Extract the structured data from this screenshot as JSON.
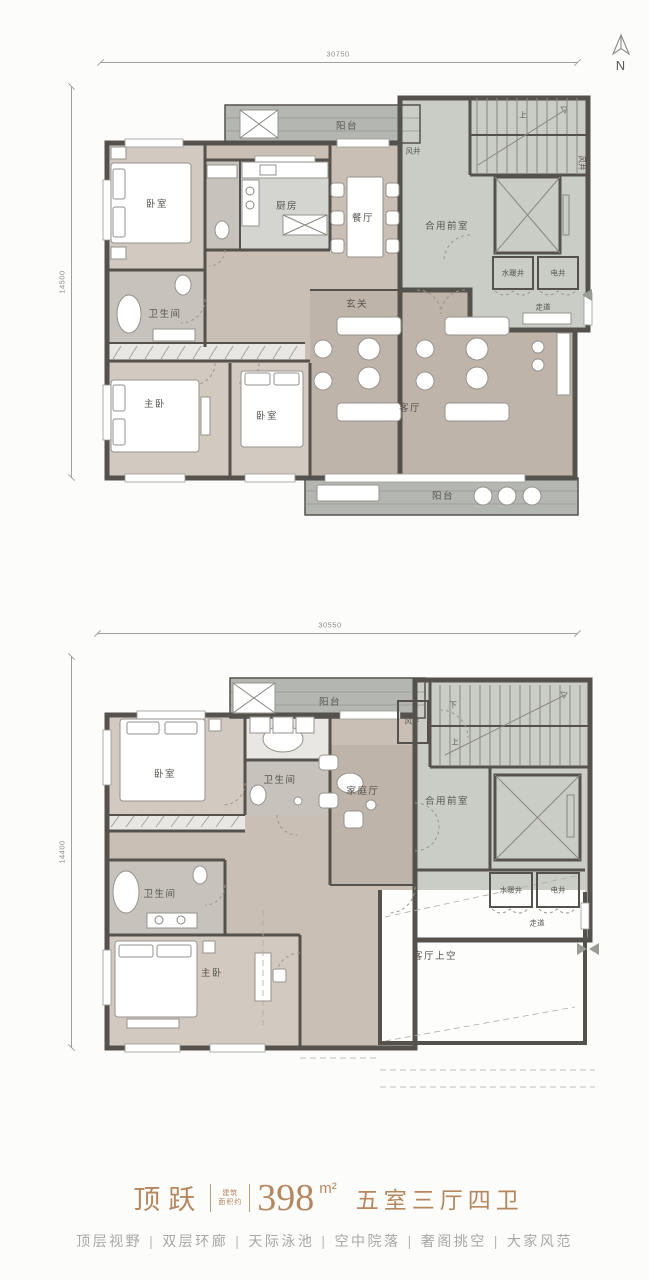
{
  "north": {
    "letter": "N"
  },
  "dimensions": {
    "upper_top": "30750",
    "upper_left": "14500",
    "lower_top": "30550",
    "lower_left": "14400"
  },
  "plans": {
    "upper": {
      "labels": {
        "balcony_top": "阳台",
        "air_shaft": "风井",
        "air_shaft2": "风井",
        "stair_up": "上",
        "kitchen": "厨房",
        "dining": "餐厅",
        "vestibule": "合用前室",
        "bedroom1": "卧室",
        "bath1": "卫生间",
        "foyer": "玄关",
        "plumbing_shaft": "水暖井",
        "electric_shaft": "电井",
        "corridor": "走道",
        "master_bedroom": "主卧",
        "bedroom2": "卧室",
        "living": "客厅",
        "balcony_bottom": "阳台"
      }
    },
    "lower": {
      "labels": {
        "balcony_top": "阳台",
        "bedroom": "卧室",
        "bath1": "卫生间",
        "family_room": "家庭厅",
        "air_shaft": "风井",
        "stair_down": "下",
        "stair_up": "上",
        "vestibule": "合用前室",
        "plumbing_shaft": "水暖井",
        "electric_shaft": "电井",
        "corridor": "走道",
        "bath2": "卫生间",
        "master_bedroom": "主卧",
        "living_void": "客厅上空"
      }
    }
  },
  "footer": {
    "title_name": "顶跃",
    "area_prefix_line1": "建筑",
    "area_prefix_line2": "面积约",
    "area_value": "398",
    "area_unit": "m²",
    "title_rooms": "五室三厅四卫",
    "separator": "|",
    "features": [
      "顶层视野",
      "双层环廊",
      "天际泳池",
      "空中院落",
      "奢阁挑空",
      "大家风范"
    ]
  },
  "colors": {
    "accent_bronze": "#b5875f",
    "feature_gray": "#a7a7a5",
    "floor_warm": "#c9bfb5",
    "floor_core": "#c9cdc6",
    "balcony_gray": "#b4b7b1",
    "wall_dark": "#55524d"
  }
}
